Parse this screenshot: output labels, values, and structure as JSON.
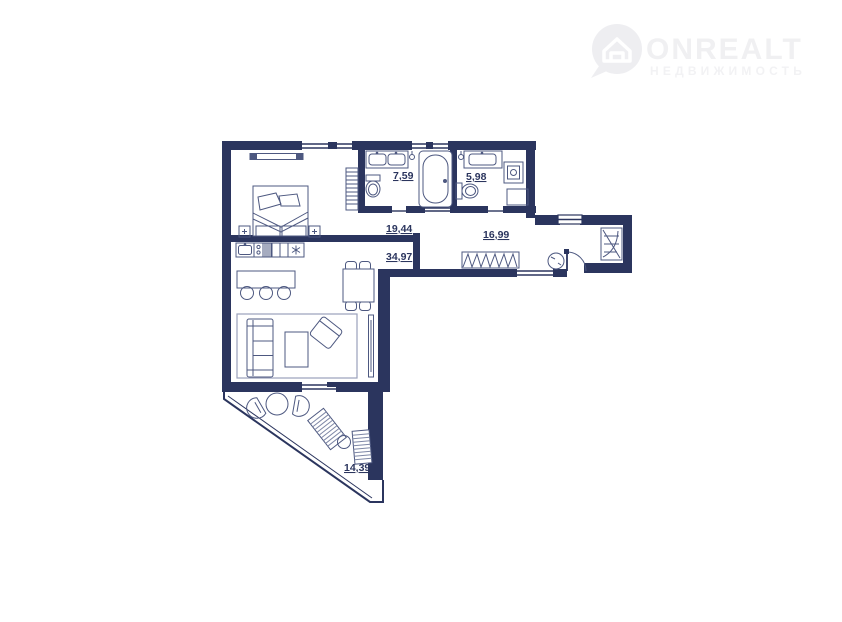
{
  "watermark": {
    "brand": "ONREALT",
    "subtitle": "НЕДВИЖИМОСТЬ",
    "color": "#f0f0f2"
  },
  "floor_plan": {
    "wall_color": "#2b355e",
    "furniture_color": "#4d5880",
    "label_color": "#2b355e",
    "rooms": [
      {
        "id": "bathroom-main",
        "area": "7,59"
      },
      {
        "id": "bathroom-guest",
        "area": "5,98"
      },
      {
        "id": "bedroom",
        "area": "19,44"
      },
      {
        "id": "hallway",
        "area": "16,99"
      },
      {
        "id": "living-kitchen",
        "area": "34,97"
      },
      {
        "id": "terrace",
        "area": "14,39"
      }
    ]
  }
}
